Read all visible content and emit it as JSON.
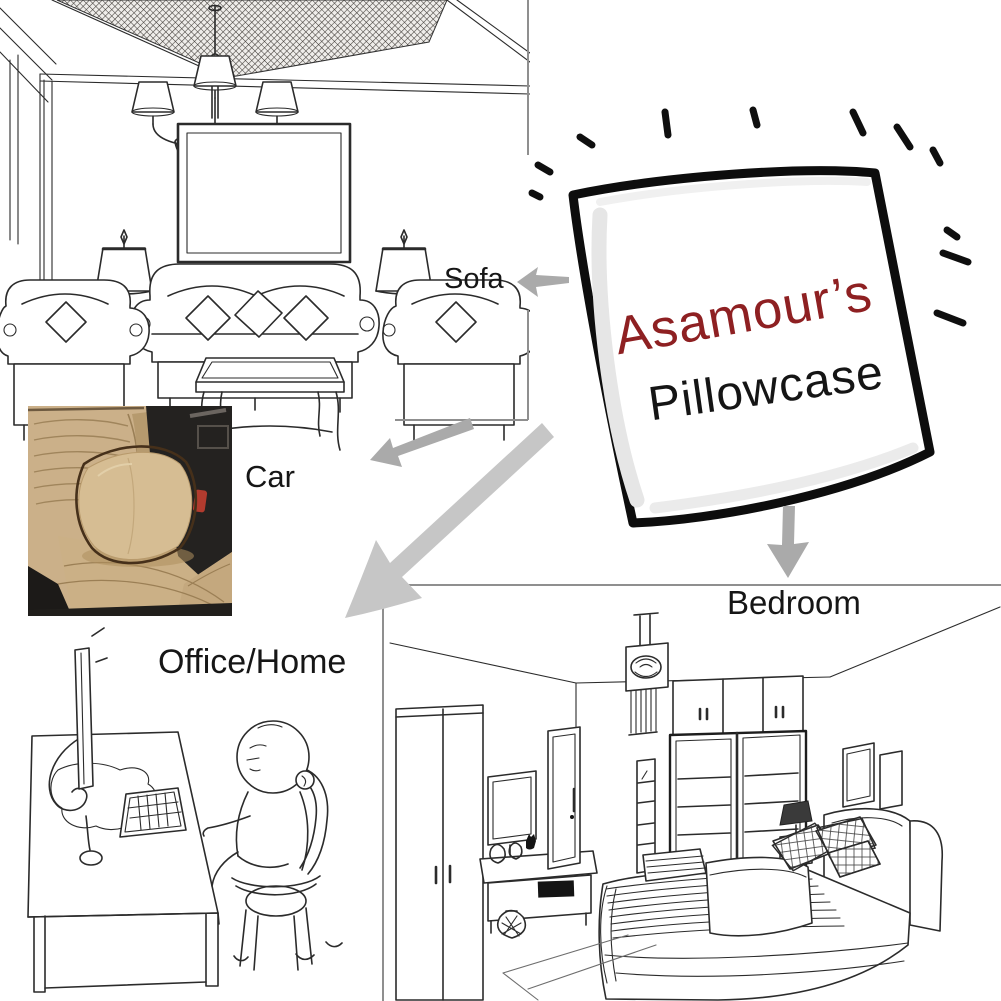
{
  "canvas": {
    "width": 1001,
    "height": 1001,
    "background": "#ffffff"
  },
  "pillow_graphic": {
    "brand_text": "Asamour’s",
    "product_text": "Pillowcase",
    "brand_color": "#8e2022",
    "product_color": "#151515",
    "outline_color": "#0d0d0d"
  },
  "usage_labels": {
    "sofa": "Sofa",
    "car": "Car",
    "office_home": "Office/Home",
    "bedroom": "Bedroom"
  },
  "label_text_color": "#161616",
  "arrows": {
    "color": "#aaaaaa",
    "big_arrow_color": "#c6c6c6"
  },
  "illustrations": {
    "living_room": "line-art living room with chandelier, wall picture, table lamps and sofa set",
    "car_seat": "photo of a beige pillow on a tan leather car seat",
    "office_home": "cartoon person slouched at a computer desk",
    "bedroom": "line-art bedroom with wardrobe, TV unit and double bed"
  },
  "line_art_color": "#2b2b2b"
}
